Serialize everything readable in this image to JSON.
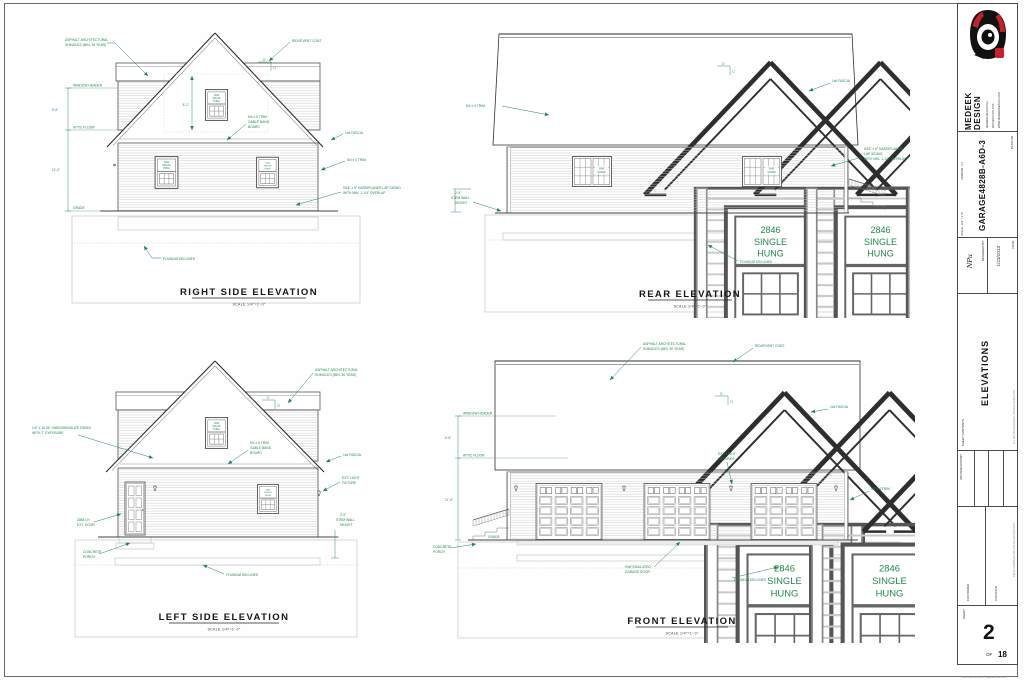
{
  "sheet": {
    "brand": "MEDEEK DESIGN",
    "address_lines": [
      "MEDEEK DESIGN INC.",
      "WASHINGTON, USA",
      "WWW.MEDEEKDESIGN.COM"
    ],
    "plan_label": "PLAN NO.",
    "plan_no": "GARAGE4828B-A6D-3",
    "scale_label": "SCALE : 1/4\" = 1'-0\"",
    "version_label": "VERSION : 2.1",
    "designed_label": "DESIGNED BY:",
    "designed_value": "NPu",
    "date_label": "DATE:",
    "date_value": "1/23/2013",
    "contents_label": "SHEET CONTENTS",
    "contents_value": "ELEVATIONS",
    "revision_label": "REVISION HISTORY",
    "customer_label": "CUSTOMER",
    "location_label": "LOCATION",
    "sheet_label": "SHEET",
    "sheet_no": "2",
    "of_label": "OF",
    "sheet_total": "18",
    "fine_print_side": "ALL RIGHTS RESERVED - MEDEEK DESIGN INC.",
    "fine_print_side2": "THESE DRAWINGS MAY NOT BE REPRODUCED",
    "fine_print_bottom": "PRINTED 1/23/2013 - MEDEEK DESIGN"
  },
  "titles": {
    "right": "RIGHT SIDE ELEVATION",
    "rear": "REAR ELEVATION",
    "left": "LEFT SIDE ELEVATION",
    "front": "FRONT ELEVATION",
    "scale": "SCALE 1/4\"=1'-0\""
  },
  "ann": {
    "asphalt1": "ASPHALT ARCHITECTURAL",
    "asphalt2": "SHINGLES (MIN. 30 YEAR)",
    "ridgevent": "RIDGEVENT CONT.",
    "gable_band1": "5/4 x 5 TRIM",
    "gable_band2": "GABLE BAND",
    "gable_band3": "BOARD",
    "fascia": "1x6 FASCIA",
    "trim_5x4": "5/4 x 4 TRIM",
    "hardiplank_a1": "5/16\" x 8\" HARDIPLANK® LAP SIDING",
    "hardiplank_a2": "WITH MIN. 1-1/4\" OVERLAP",
    "hardiplank_b1": "5/16\" x 8\" HARDIPLANK®",
    "hardiplank_b2": "LAP SIDING",
    "hardiplank_b3": "WITH MIN. 1-1/4\" OVERLAP",
    "hardishingle1": "1/4\" x 15.25\" HARDISHINGLE® SIDING",
    "hardishingle2": "WITH 7\" EXPOSURE",
    "foundation": "FOUNDATION LINES",
    "window_header": "WINDOW HEADER",
    "attic_floor": "ATTIC FLOOR",
    "grade": "GRADE",
    "dim_6_6": "6'-6\"",
    "dim_11_4": "11'-4\"",
    "dim_8_1": "8'-1\"",
    "stem1": "2'-6\"",
    "stem2": "STEM WALL",
    "stem3": "HEIGHT",
    "ext_light1": "EXT. LIGHT",
    "ext_light_fixture": "FIXTURE",
    "ext_light_fixtures": "FIXTURES",
    "door1": "3068 LH",
    "door2": "EXT. DOOR",
    "porch1": "CONCRETE",
    "porch2": "PORCH",
    "garage_door1": "9'x8' INSULATED",
    "garage_door2": "GARAGE DOOR",
    "pitch": "12"
  },
  "labels": {
    "window1": "2846",
    "window2": "SINGLE",
    "window3": "HUNG",
    "slider1": "6046",
    "slider2": "SLIDER"
  },
  "colors": {
    "annotation_green": "#1f8a4d",
    "logo_red": "#c8202b",
    "logo_black": "#111111",
    "line_dark": "#555555"
  }
}
